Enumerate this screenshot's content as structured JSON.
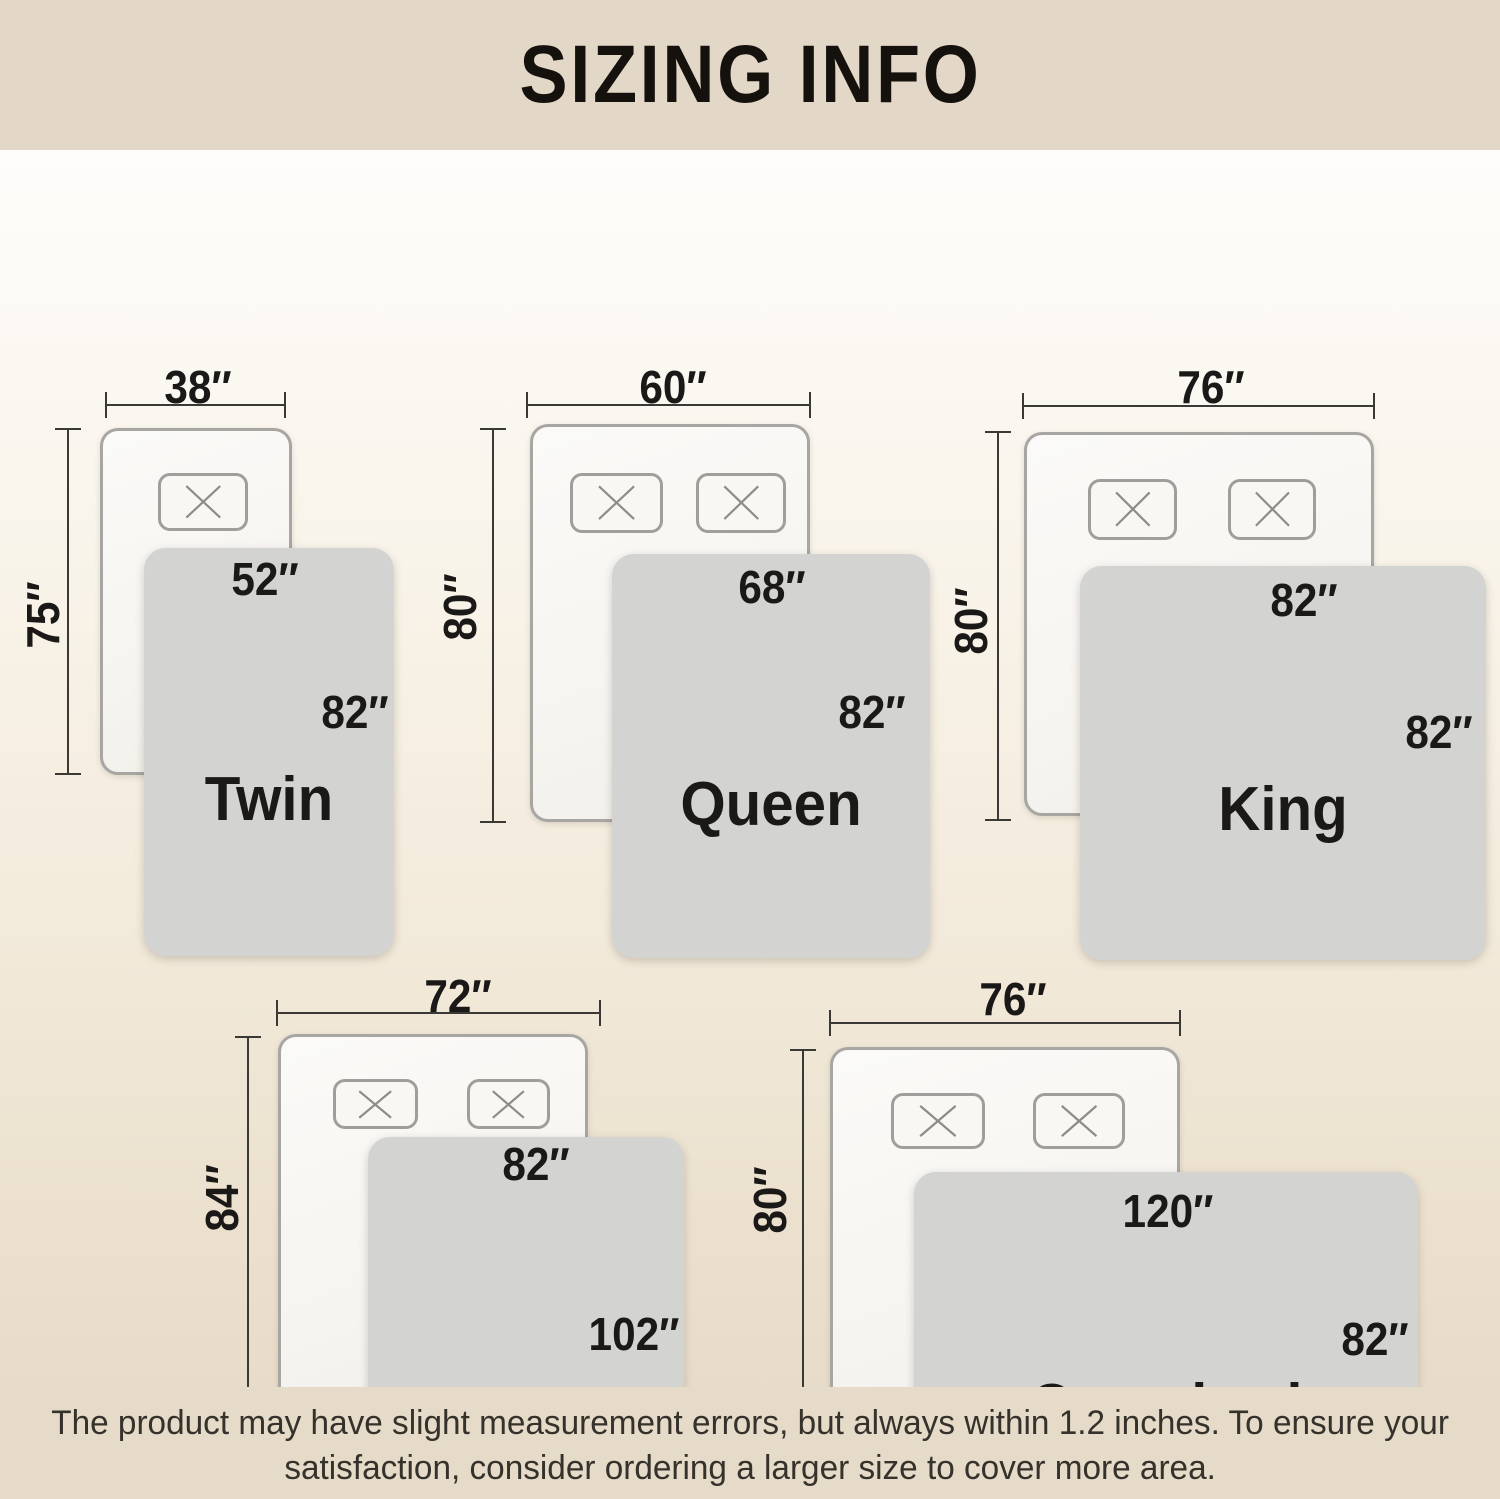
{
  "header": {
    "title": "SIZING INFO"
  },
  "diagrams": [
    {
      "name": "Twin",
      "mattress_width": "38″",
      "mattress_height": "75″",
      "blanket_width": "52″",
      "blanket_height": "82″",
      "pillow_count": 1
    },
    {
      "name": "Queen",
      "mattress_width": "60″",
      "mattress_height": "80″",
      "blanket_width": "68″",
      "blanket_height": "82″",
      "pillow_count": 2
    },
    {
      "name": "King",
      "mattress_width": "76″",
      "mattress_height": "80″",
      "blanket_width": "82″",
      "blanket_height": "82″",
      "pillow_count": 2
    },
    {
      "name": "California King",
      "mattress_width": "72″",
      "mattress_height": "84″",
      "blanket_width": "82″",
      "blanket_height": "102″",
      "pillow_count": 2
    },
    {
      "name": "Oversized King",
      "mattress_width": "76″",
      "mattress_height": "80″",
      "blanket_width": "120″",
      "blanket_height": "82″",
      "pillow_count": 2
    }
  ],
  "disclaimer": {
    "line1": "The product may have slight measurement errors, but always within 1.2 inches. To ensure your",
    "line2": "satisfaction, consider ordering a larger size to cover more area."
  },
  "icons": {
    "pillow_x": "✕"
  },
  "colors": {
    "header_bg": "#e3d8c7",
    "footer_bg": "#e6dbc9",
    "background_top": "#fdfcfa",
    "background_bottom": "#e7dcc9",
    "blanket": "#d3d4d2",
    "mattress": "#f8f7f4",
    "mattress_border": "#a8a6a2",
    "dimension_line": "#3b3936",
    "text": "#1b1918"
  }
}
